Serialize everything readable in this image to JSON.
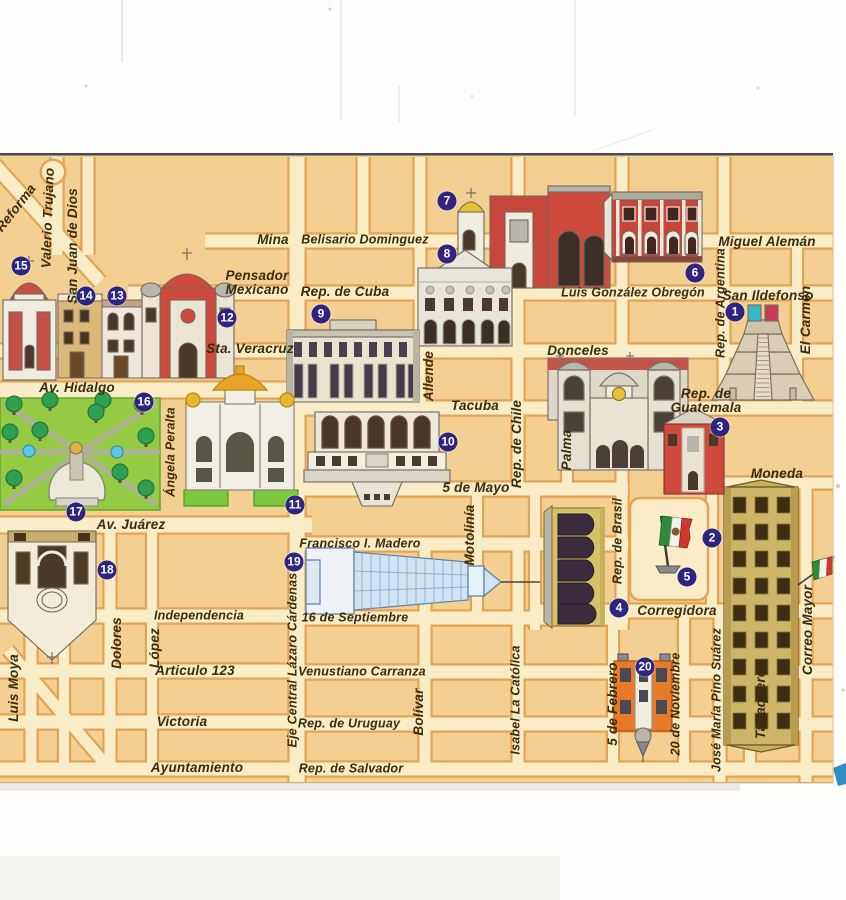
{
  "map": {
    "description_labels": {
      "type": "illustrated-street-map"
    },
    "colors": {
      "block": "#f4cf92",
      "street": "#f9ecc6",
      "street_border": "#e2a353",
      "marker": "#2f2580",
      "ink": "#3b2b0a",
      "park_green": "#94ca44",
      "edge_cyan": "#2f8fc4"
    },
    "street_labels": [
      {
        "t": "Reforma",
        "x": 16,
        "y": 208,
        "r": -52
      },
      {
        "t": "Valerio Trujano",
        "x": 48,
        "y": 218,
        "r": -88
      },
      {
        "t": "San Juan de Dios",
        "x": 73,
        "y": 246,
        "r": -90
      },
      {
        "t": "Mina",
        "x": 273,
        "y": 240,
        "r": 0
      },
      {
        "t": "Belisario Dominguez",
        "x": 365,
        "y": 240,
        "r": 0,
        "s": 12.5
      },
      {
        "t": "Pensador",
        "l2": "Mexicano",
        "x": 257,
        "y": 283,
        "r": 0
      },
      {
        "t": "Rep. de Cuba",
        "x": 345,
        "y": 292,
        "r": 0
      },
      {
        "t": "Miguel Alemán",
        "x": 767,
        "y": 242,
        "r": 0
      },
      {
        "t": "Luis González Obregón",
        "x": 633,
        "y": 293,
        "r": 0,
        "s": 12.5
      },
      {
        "t": "San Ildefonso",
        "x": 768,
        "y": 296,
        "r": 0
      },
      {
        "t": "Rep. de Argentina",
        "x": 721,
        "y": 303,
        "r": -90,
        "s": 12.5
      },
      {
        "t": "El Carmen",
        "x": 806,
        "y": 320,
        "r": -90
      },
      {
        "t": "Sta. Veracruz",
        "x": 250,
        "y": 349,
        "r": 0
      },
      {
        "t": "Donceles",
        "x": 578,
        "y": 351,
        "r": 0
      },
      {
        "t": "Av. Hidalgo",
        "x": 77,
        "y": 388,
        "r": 0
      },
      {
        "t": "Tacuba",
        "x": 475,
        "y": 406,
        "r": 0
      },
      {
        "t": "Rep. de",
        "l2": "Guatemala",
        "x": 706,
        "y": 401,
        "r": 0
      },
      {
        "t": "Allende",
        "x": 429,
        "y": 376,
        "r": -90
      },
      {
        "t": "Rep. de Chile",
        "x": 517,
        "y": 444,
        "r": -90
      },
      {
        "t": "Palma",
        "x": 567,
        "y": 450,
        "r": -90
      },
      {
        "t": "Ángela Peralta",
        "x": 171,
        "y": 452,
        "r": -90,
        "s": 12.5
      },
      {
        "t": "5 de Mayo",
        "x": 476,
        "y": 488,
        "r": 0
      },
      {
        "t": "Moneda",
        "x": 777,
        "y": 474,
        "r": 0
      },
      {
        "t": "Av. Juárez",
        "x": 131,
        "y": 525,
        "r": 0
      },
      {
        "t": "Francisco I. Madero",
        "x": 360,
        "y": 544,
        "r": 0,
        "s": 12.5
      },
      {
        "t": "Motolinía",
        "x": 470,
        "y": 535,
        "r": -90
      },
      {
        "t": "Rep. de Brasil",
        "x": 618,
        "y": 541,
        "r": -90,
        "s": 12.5
      },
      {
        "t": "Corregidora",
        "x": 677,
        "y": 611,
        "r": 0
      },
      {
        "t": "Independencia",
        "x": 199,
        "y": 616,
        "r": 0,
        "s": 12.5
      },
      {
        "t": "16 de Septiembre",
        "x": 355,
        "y": 618,
        "r": 0,
        "s": 12.5
      },
      {
        "t": "Eje Central Lázaro Cárdenas",
        "x": 293,
        "y": 660,
        "r": -90,
        "s": 12.5
      },
      {
        "t": "Dolores",
        "x": 117,
        "y": 643,
        "r": -90
      },
      {
        "t": "López",
        "x": 155,
        "y": 648,
        "r": -90
      },
      {
        "t": "Luis Moya",
        "x": 14,
        "y": 688,
        "r": -90
      },
      {
        "t": "Articulo 123",
        "x": 195,
        "y": 671,
        "r": 0
      },
      {
        "t": "Venustiano Carranza",
        "x": 362,
        "y": 672,
        "r": 0,
        "s": 12.5
      },
      {
        "t": "Victoria",
        "x": 182,
        "y": 722,
        "r": 0
      },
      {
        "t": "Rep. de Uruguay",
        "x": 349,
        "y": 724,
        "r": 0,
        "s": 12.5
      },
      {
        "t": "Bolívar",
        "x": 419,
        "y": 712,
        "r": -90
      },
      {
        "t": "Isabel La Católica",
        "x": 516,
        "y": 700,
        "r": -90,
        "s": 12.5
      },
      {
        "t": "Ayuntamiento",
        "x": 197,
        "y": 768,
        "r": 0
      },
      {
        "t": "Rep. de Salvador",
        "x": 351,
        "y": 769,
        "r": 0,
        "s": 12.5
      },
      {
        "t": "5 de Febrero",
        "x": 613,
        "y": 704,
        "r": -90
      },
      {
        "t": "20 de Noviembre",
        "x": 676,
        "y": 704,
        "r": -90,
        "s": 12.5
      },
      {
        "t": "José María Pino Suárez",
        "x": 717,
        "y": 700,
        "r": -90,
        "s": 12.5
      },
      {
        "t": "Tabaqueros",
        "x": 761,
        "y": 700,
        "r": -90
      },
      {
        "t": "Correo Mayor",
        "x": 808,
        "y": 630,
        "r": -90
      }
    ],
    "markers": [
      {
        "n": "1",
        "x": 735,
        "y": 312
      },
      {
        "n": "2",
        "x": 712,
        "y": 538
      },
      {
        "n": "3",
        "x": 720,
        "y": 427
      },
      {
        "n": "4",
        "x": 619,
        "y": 608
      },
      {
        "n": "5",
        "x": 687,
        "y": 577
      },
      {
        "n": "6",
        "x": 695,
        "y": 273
      },
      {
        "n": "7",
        "x": 447,
        "y": 201
      },
      {
        "n": "8",
        "x": 447,
        "y": 254
      },
      {
        "n": "9",
        "x": 321,
        "y": 314
      },
      {
        "n": "10",
        "x": 448,
        "y": 442
      },
      {
        "n": "11",
        "x": 295,
        "y": 505
      },
      {
        "n": "12",
        "x": 227,
        "y": 318
      },
      {
        "n": "13",
        "x": 117,
        "y": 296
      },
      {
        "n": "14",
        "x": 86,
        "y": 296
      },
      {
        "n": "15",
        "x": 21,
        "y": 266
      },
      {
        "n": "16",
        "x": 144,
        "y": 402
      },
      {
        "n": "17",
        "x": 76,
        "y": 512
      },
      {
        "n": "18",
        "x": 107,
        "y": 570
      },
      {
        "n": "19",
        "x": 294,
        "y": 562
      },
      {
        "n": "20",
        "x": 645,
        "y": 667
      }
    ]
  }
}
